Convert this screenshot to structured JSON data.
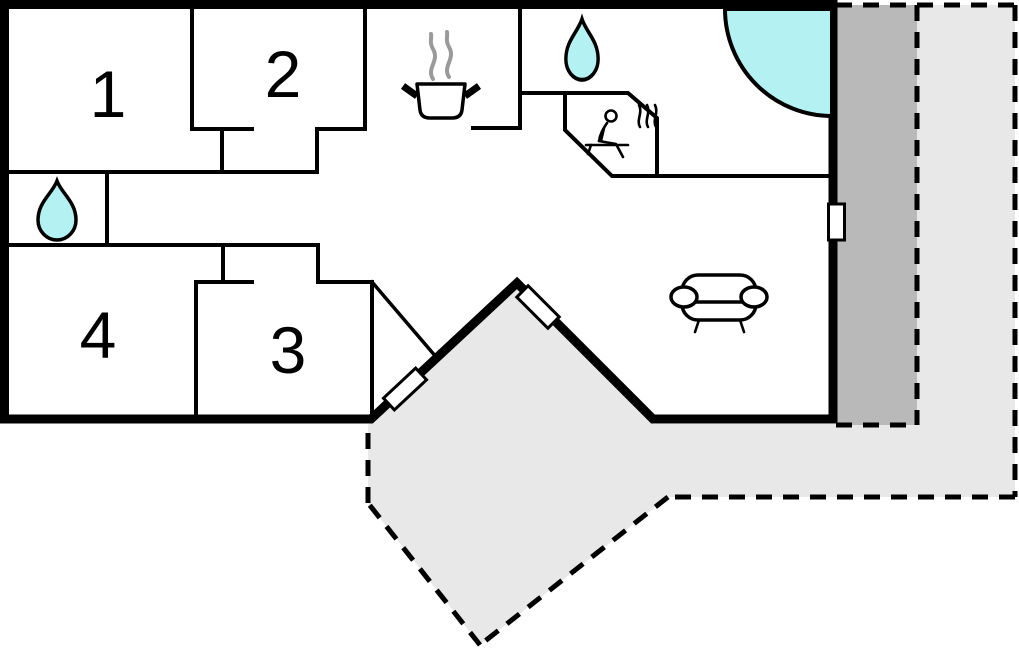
{
  "rooms": [
    {
      "label": "1"
    },
    {
      "label": "2"
    },
    {
      "label": "3"
    },
    {
      "label": "4"
    }
  ],
  "icons": [
    {
      "name": "water-drop-icon",
      "area": "small bathroom left"
    },
    {
      "name": "water-drop-icon",
      "area": "bathroom top"
    },
    {
      "name": "cooking-pot-icon",
      "area": "kitchen"
    },
    {
      "name": "sauna-person-icon",
      "area": "sauna"
    },
    {
      "name": "corner-bathtub-icon",
      "area": "top-right corner"
    },
    {
      "name": "sofa-icon",
      "area": "living room"
    },
    {
      "name": "door-marker",
      "area": "right wall"
    },
    {
      "name": "door-marker",
      "area": "entry left diagonal"
    },
    {
      "name": "door-marker",
      "area": "entry right diagonal"
    }
  ],
  "colors": {
    "wall": "#000000",
    "water_fixture": "#b3f1f2",
    "deck_dark": "#b9b9b9",
    "terrace_light": "#e8e8e8",
    "steam": "#9a9a9a",
    "background": "#ffffff"
  }
}
